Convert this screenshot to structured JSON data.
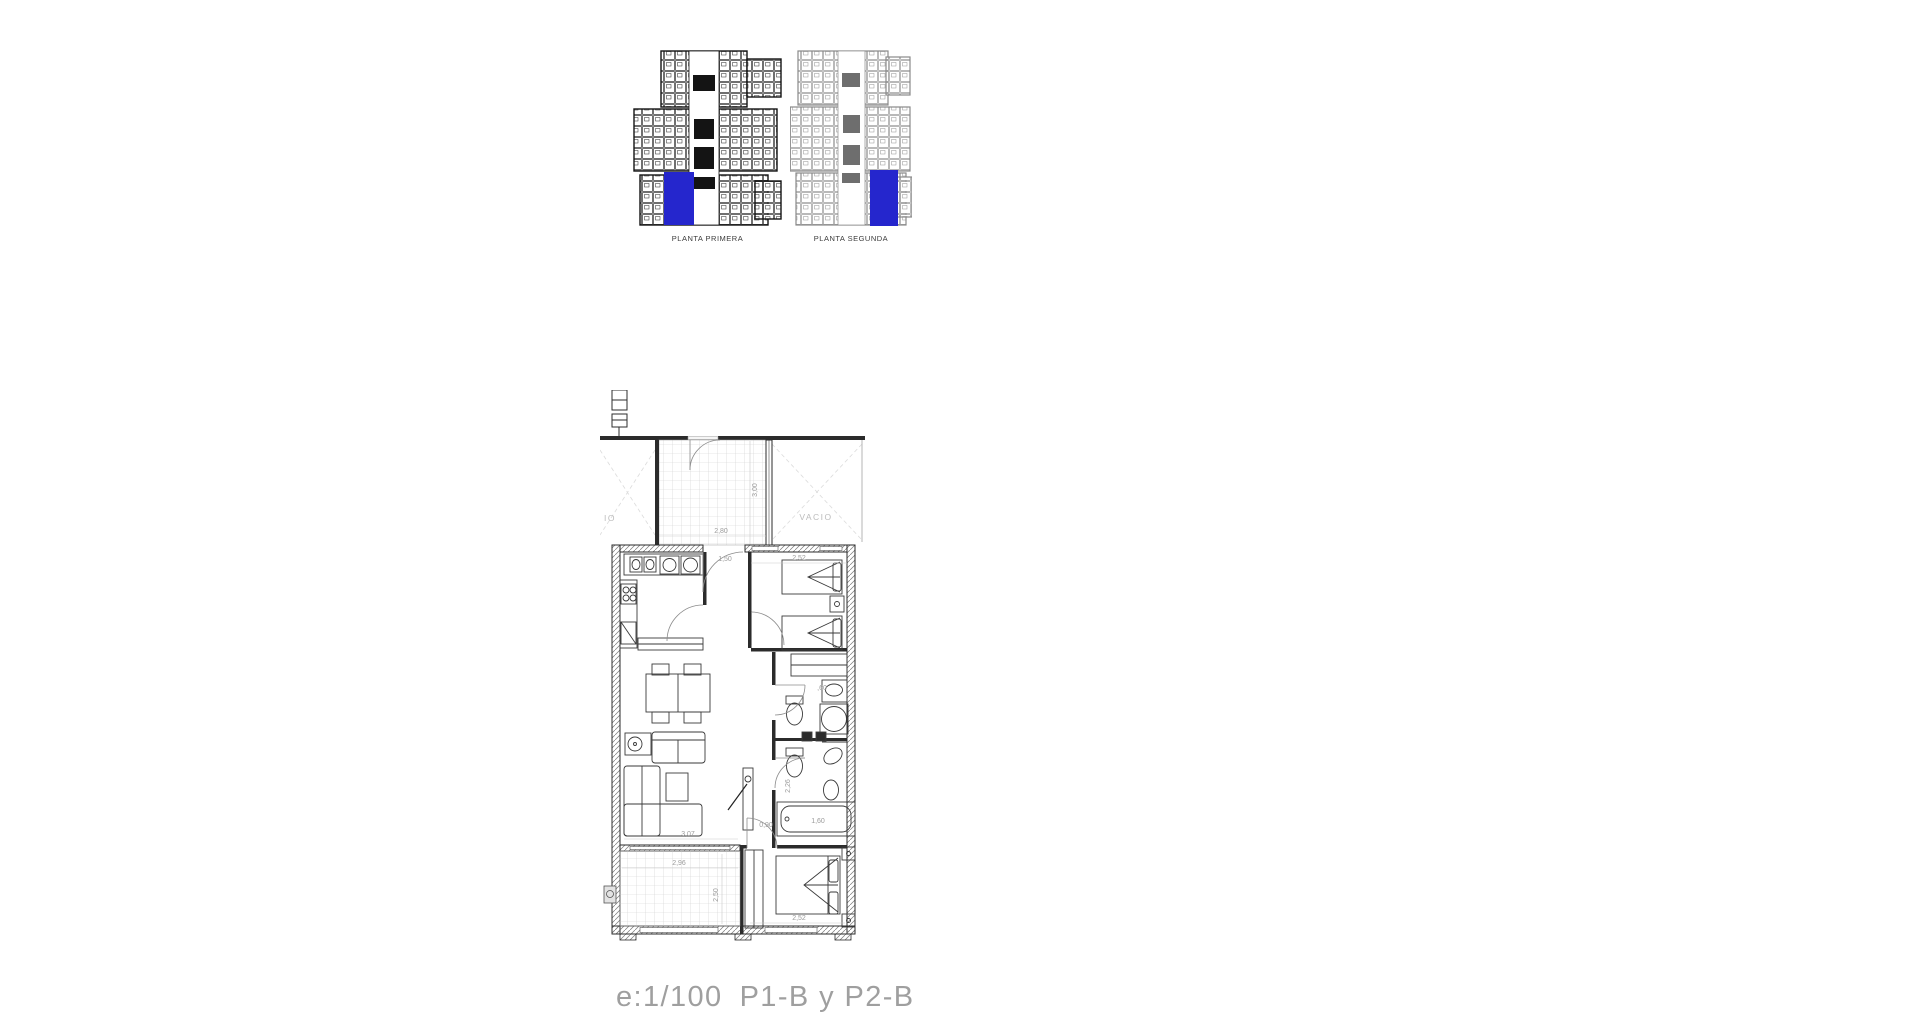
{
  "colors": {
    "highlight": "#2526cd"
  },
  "overview": {
    "plans": [
      {
        "label": "PLANTA PRIMERA"
      },
      {
        "label": "PLANTA SEGUNDA"
      }
    ]
  },
  "floorplan": {
    "void_left": "IO",
    "void_right": "VACIO",
    "dims": {
      "patio_width": "2,80",
      "patio_depth": "3,00",
      "entry_width": "1,50",
      "bedroom2_width": "2,52",
      "wardrobe_depth": ",60",
      "bath_depth": "2,26",
      "hall_width": "0,90",
      "bathtub_length": "1,60",
      "living_width": "3,07",
      "terrace_width": "2,96",
      "terrace_depth": "2,50",
      "bedroom1_width": "2,52"
    }
  },
  "caption": {
    "scale": "e:1/100",
    "plans": "P1-B y P2-B"
  }
}
